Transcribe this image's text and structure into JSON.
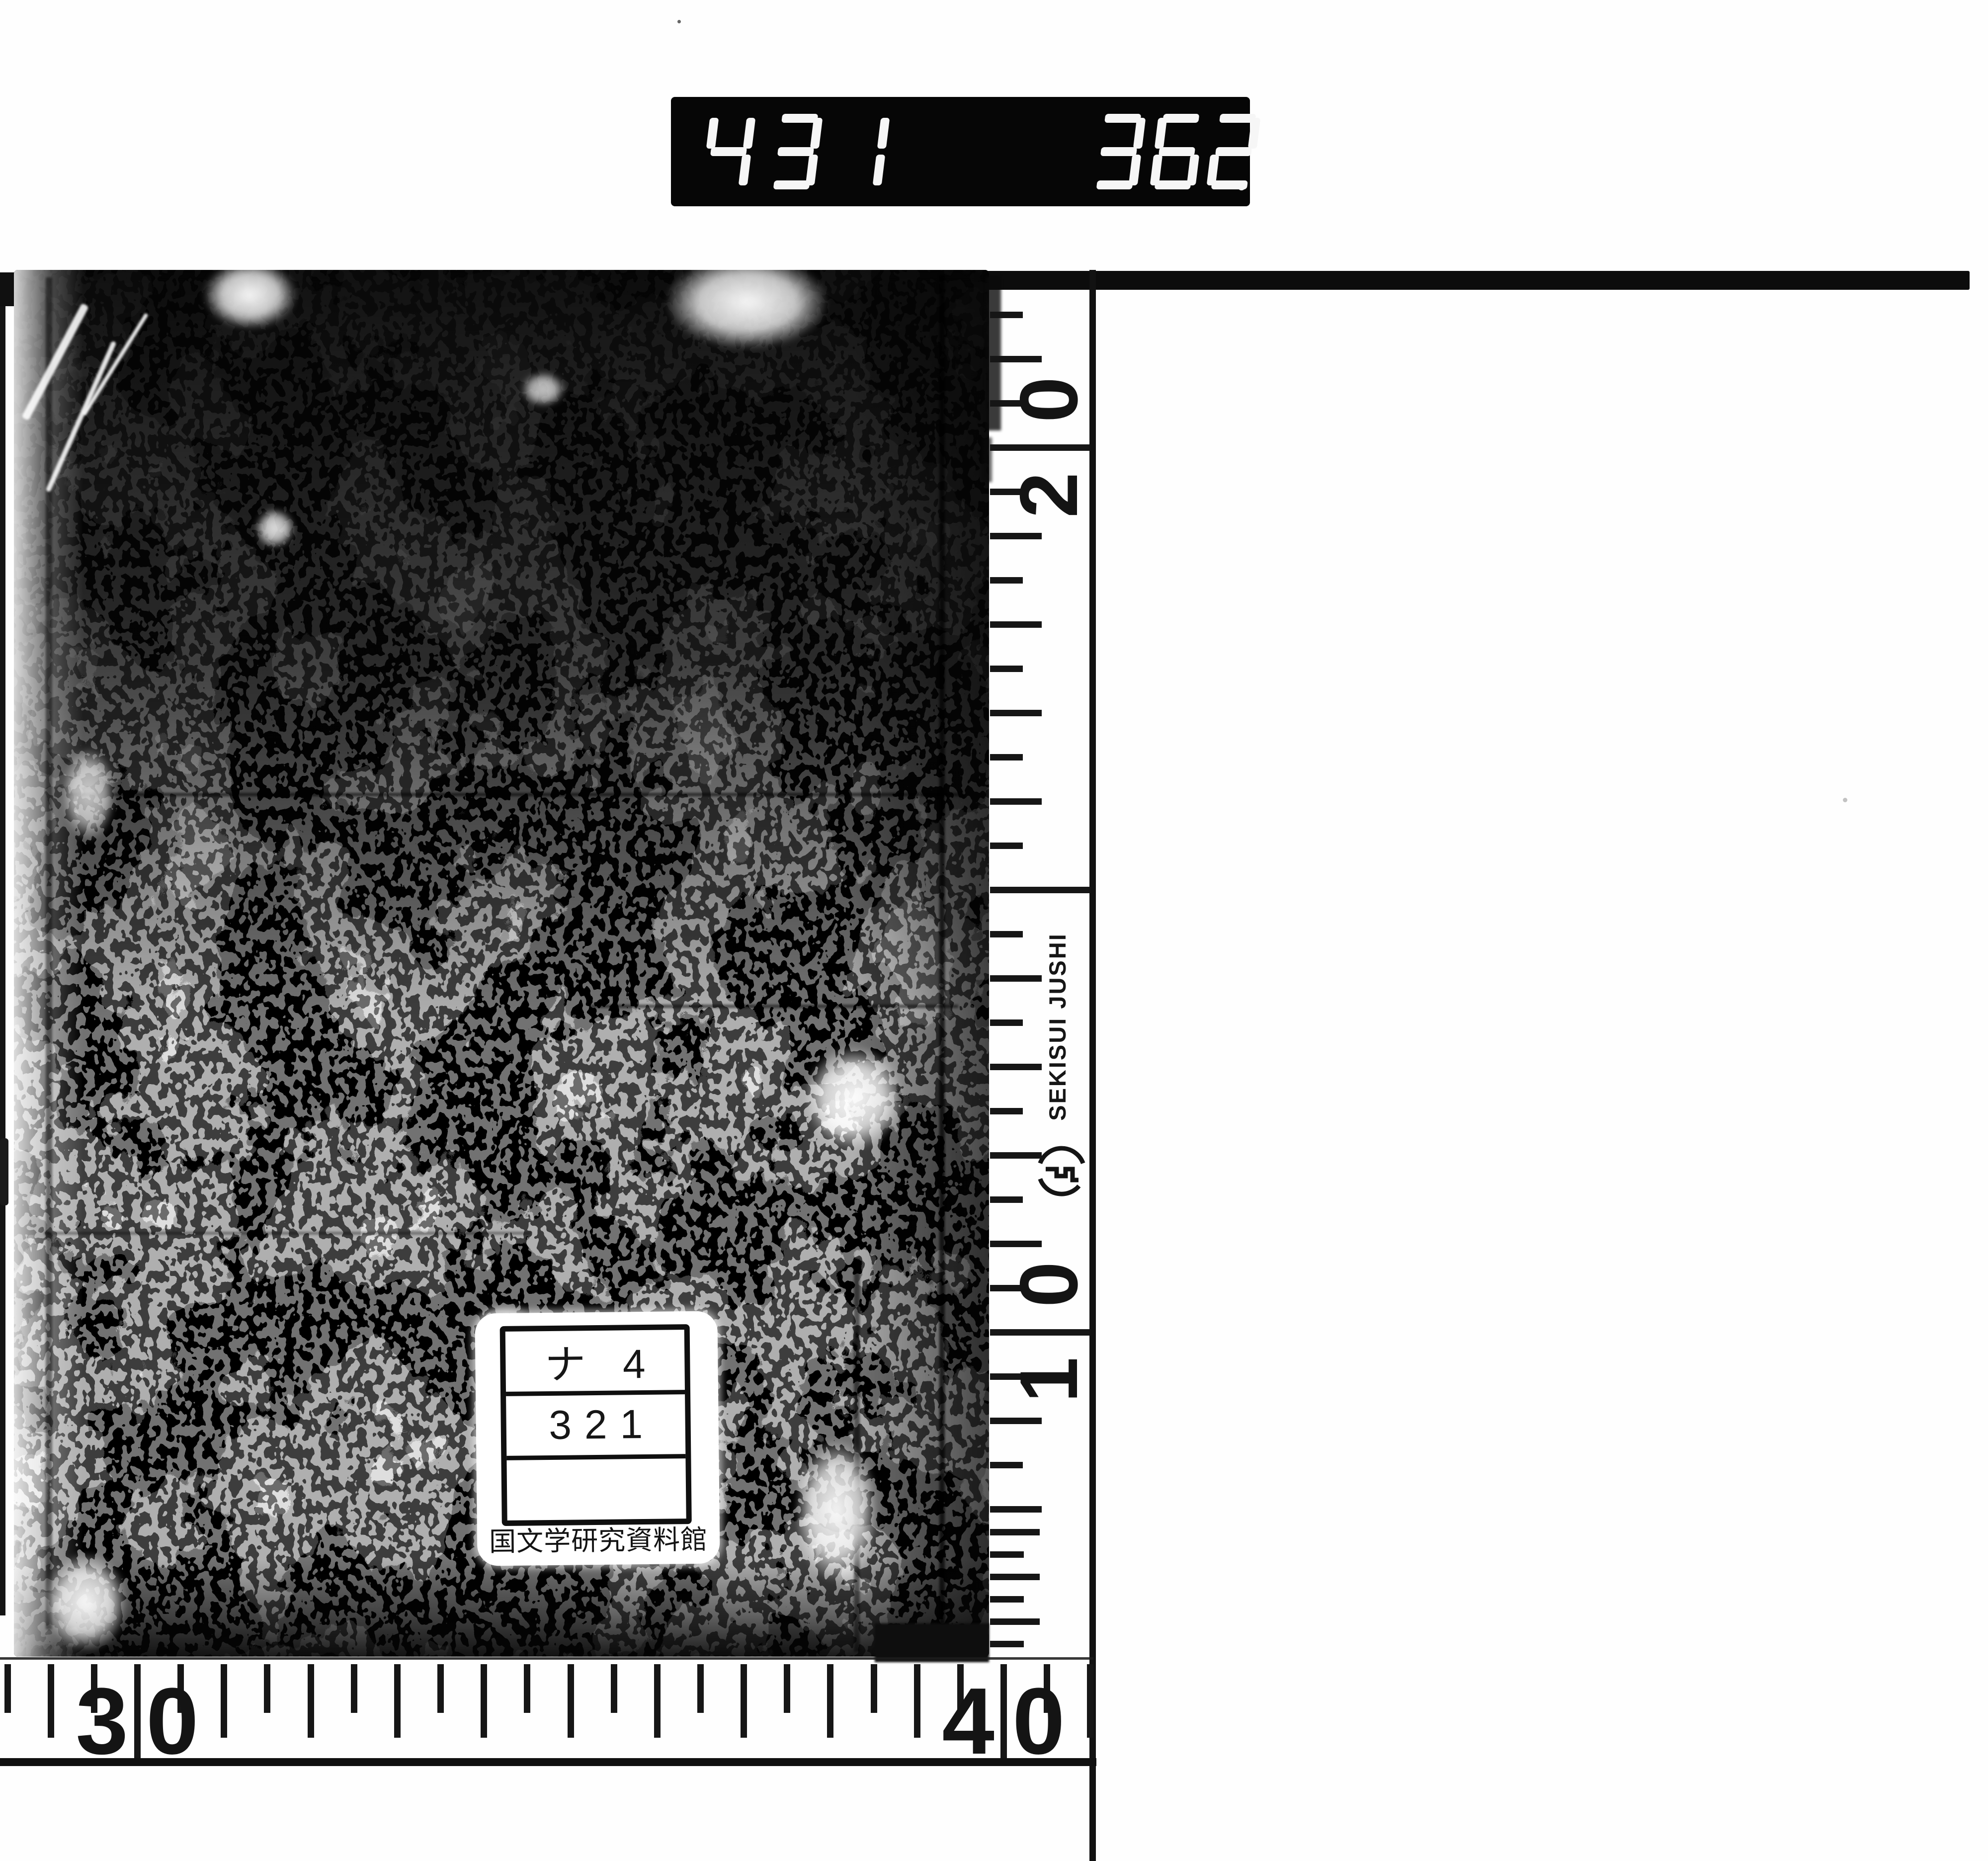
{
  "scan": {
    "counter": {
      "groups": [
        {
          "digits": "431",
          "decimal": false
        },
        {
          "digits": "362",
          "decimal": true
        }
      ]
    },
    "vertical_ruler": {
      "brand": "SEKISUI JUSHI",
      "marks": [
        "20",
        "10"
      ]
    },
    "horizontal_ruler": {
      "marks": [
        "30",
        "40"
      ]
    },
    "call_number_label": {
      "line1": "ナ 4",
      "line2": "321",
      "line3": "",
      "institution": "国文学研究資料館"
    },
    "colors": {
      "ink": "#111111",
      "paper": "#ffffff",
      "counter_bg": "#060606",
      "counter_digit": "#f6f6f6"
    }
  }
}
